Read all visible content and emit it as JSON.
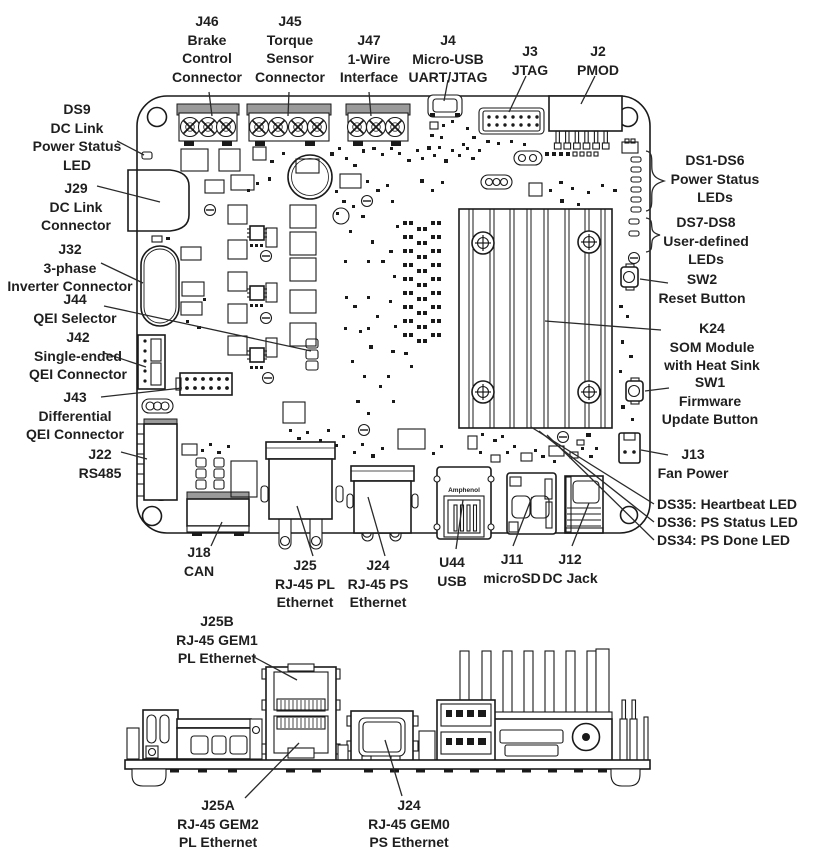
{
  "colors": {
    "line": "#1a1a1a",
    "text": "#1f1f1f",
    "background": "#ffffff",
    "connector_gray": "#9a9a9a"
  },
  "views": {
    "top": {
      "usb_brand": "Amphenol",
      "callouts": {
        "j46": "J46\nBrake\nControl\nConnector",
        "j45": "J45\nTorque\nSensor\nConnector",
        "j47": "J47\n1-Wire\nInterface",
        "j4": "J4\nMicro-USB\nUART/JTAG",
        "j3": "J3\nJTAG",
        "j2": "J2\nPMOD",
        "ds9": "DS9\nDC Link\nPower Status\nLED",
        "j29": "J29\nDC Link\nConnector",
        "j32": "J32\n3-phase\nInverter Connector",
        "j44": "J44\nQEI Selector",
        "j42": "J42\nSingle-ended\nQEI Connector",
        "j43": "J43\nDifferential\nQEI Connector",
        "j22": "J22\nRS485",
        "j18": "J18\nCAN",
        "ds1_ds6": "DS1-DS6\nPower Status\nLEDs",
        "ds7_ds8": "DS7-DS8\nUser-defined\nLEDs",
        "sw2": "SW2\nReset Button",
        "k24": "K24\nSOM Module\nwith Heat Sink",
        "sw1": "SW1\nFirmware\nUpdate Button",
        "j13": "J13\nFan Power",
        "ds35": "DS35: Heartbeat LED",
        "ds36": "DS36: PS Status LED",
        "ds34": "DS34: PS Done LED",
        "j25": "J25\nRJ-45 PL\nEthernet",
        "j24": "J24\nRJ-45 PS\nEthernet",
        "u44": "U44\nUSB",
        "j11": "J11\nmicroSD",
        "j12": "J12\nDC Jack"
      }
    },
    "side": {
      "callouts": {
        "j25b": "J25B\nRJ-45 GEM1\nPL Ethernet",
        "j25a": "J25A\nRJ-45 GEM2\nPL Ethernet",
        "j24": "J24\nRJ-45 GEM0\nPS Ethernet"
      }
    }
  }
}
